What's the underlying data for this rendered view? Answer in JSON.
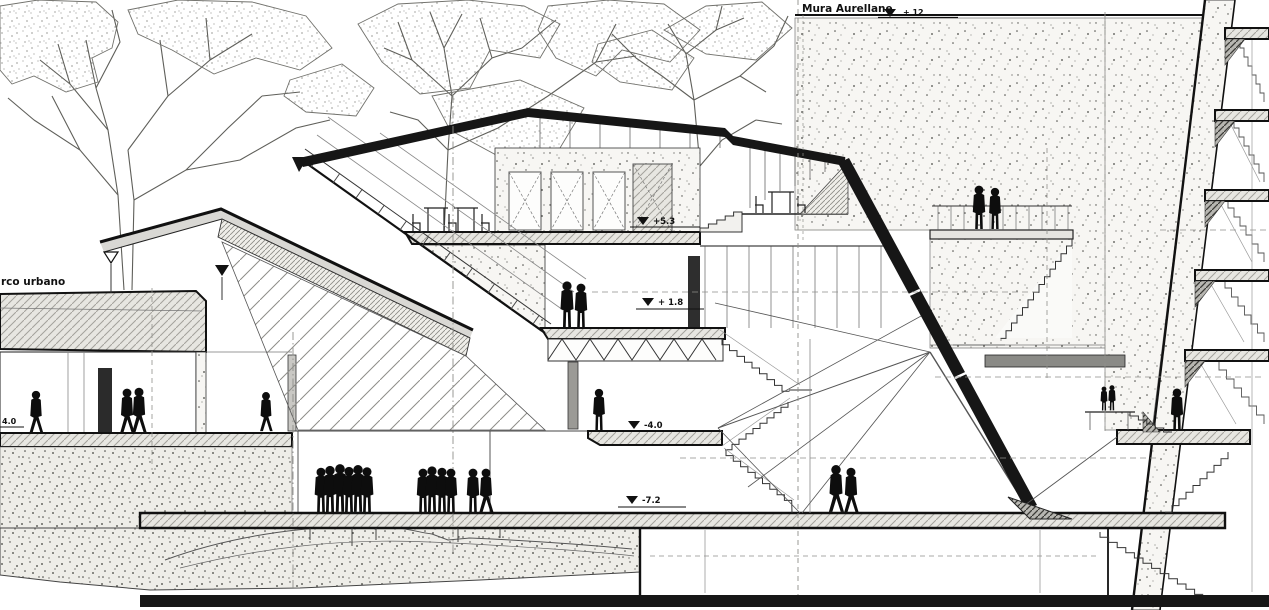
{
  "drawing": {
    "type": "architectural-longitudinal-section",
    "labels": {
      "wall_name": "Mura Aurellane",
      "park": "rco urbano"
    },
    "elevations": {
      "wall_top": "+ 12",
      "upper_floor": "+5.3",
      "terrace": "+ 1.8",
      "lower_floor": "-4.0",
      "plaza": "-7.2",
      "left_floor": "4.0"
    },
    "colors": {
      "ink": "#161616",
      "line_gray": "#6b6b66",
      "fill_light": "#e7e6e1",
      "fill_mid": "#c9c8c4",
      "stipple_bg": "#f7f6f3"
    }
  }
}
